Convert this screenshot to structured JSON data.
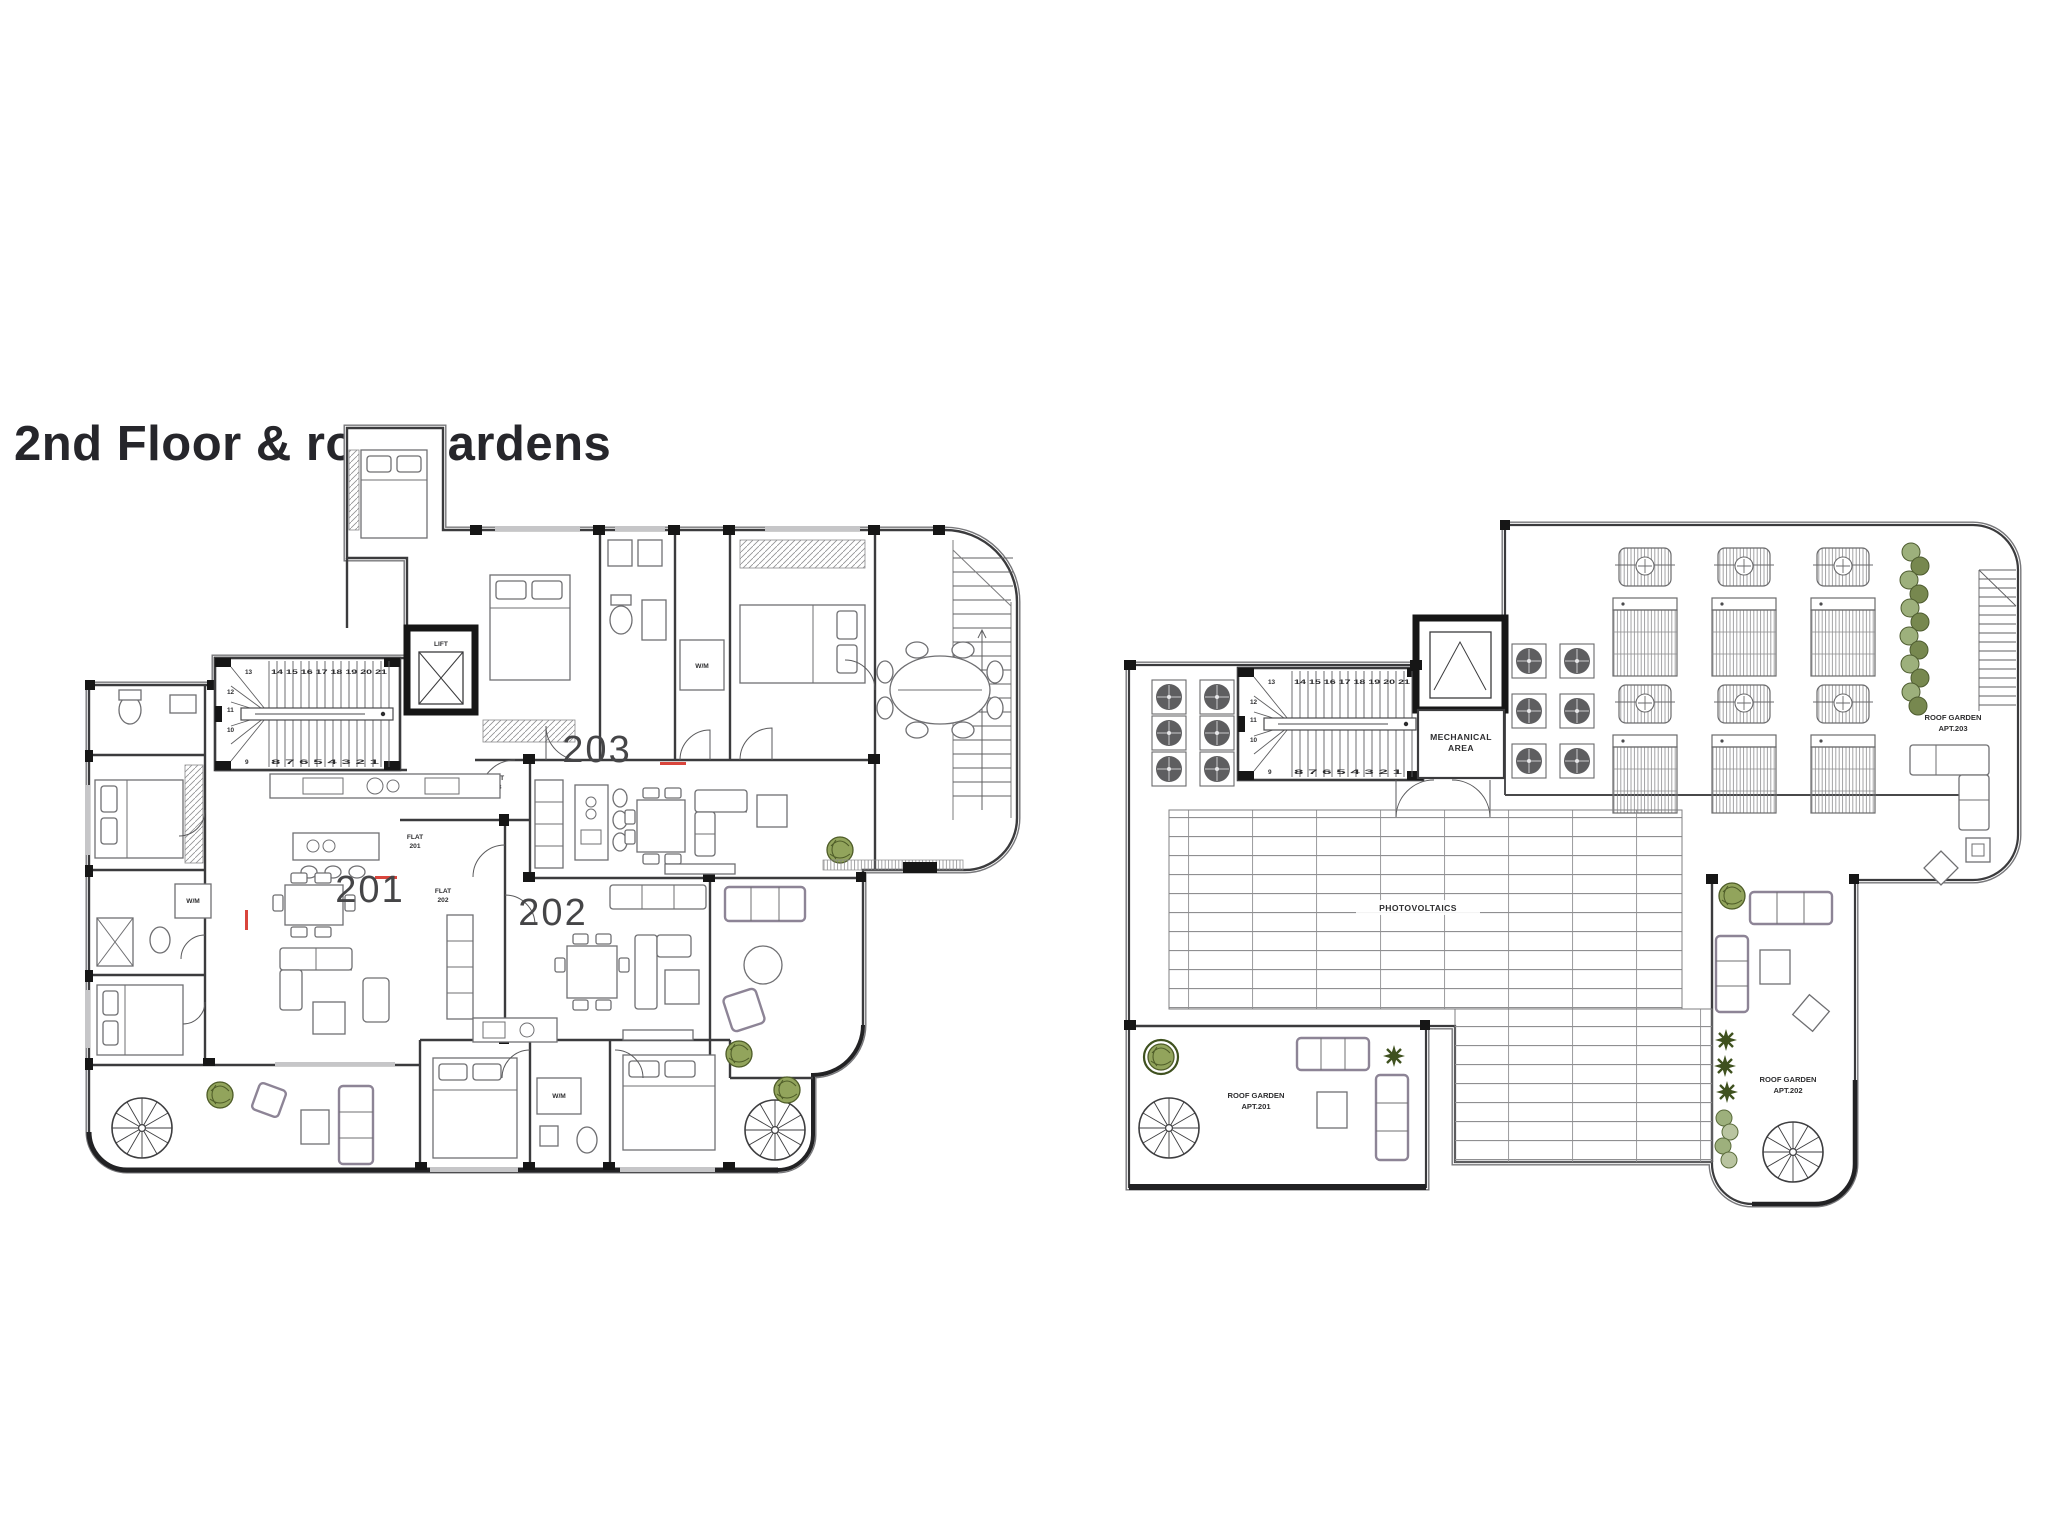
{
  "title": "2nd Floor & roof gardens",
  "colors": {
    "title_text": "#26262b",
    "wall_line": "#3b3b3d",
    "structural_black": "#161616",
    "plant_green": "#7d9747",
    "terrace_furniture_purple": "#8d8496",
    "accent_red": "#d9453c"
  },
  "floor_plan": {
    "label": "2nd floor plan",
    "lift": "LIFT",
    "stairs": {
      "top_start": "13",
      "top_row": "14 15 16 17 18 19 20 21",
      "left_1": "12",
      "left_2": "11",
      "left_3": "10",
      "bottom_start": "9",
      "bottom_row": "8 7 6 5 4 3 2 1"
    },
    "doors": {
      "flat_203_l1": "FLAT",
      "flat_203_l2": "203",
      "flat_201_l1": "FLAT",
      "flat_201_l2": "201",
      "flat_202_l1": "FLAT",
      "flat_202_l2": "202"
    },
    "units": {
      "u201": "201",
      "u202": "202",
      "u203": "203"
    },
    "appliances": {
      "wm_top": "W/M",
      "wm_left": "W/M",
      "wm_bottom": "W/M"
    }
  },
  "roof_plan": {
    "label": "roof plan",
    "stairs": {
      "top_start": "13",
      "top_row": "14 15 16 17 18 19 20 21",
      "left_1": "12",
      "left_2": "11",
      "left_3": "10",
      "bottom_start": "9",
      "bottom_row": "8 7 6 5 4 3 2 1"
    },
    "mechanical_l1": "MECHANICAL",
    "mechanical_l2": "AREA",
    "photovoltaics": "PHOTOVOLTAICS",
    "garden_201_l1": "ROOF GARDEN",
    "garden_201_l2": "APT.201",
    "garden_202_l1": "ROOF GARDEN",
    "garden_202_l2": "APT.202",
    "garden_203_l1": "ROOF GARDEN",
    "garden_203_l2": "APT.203"
  }
}
